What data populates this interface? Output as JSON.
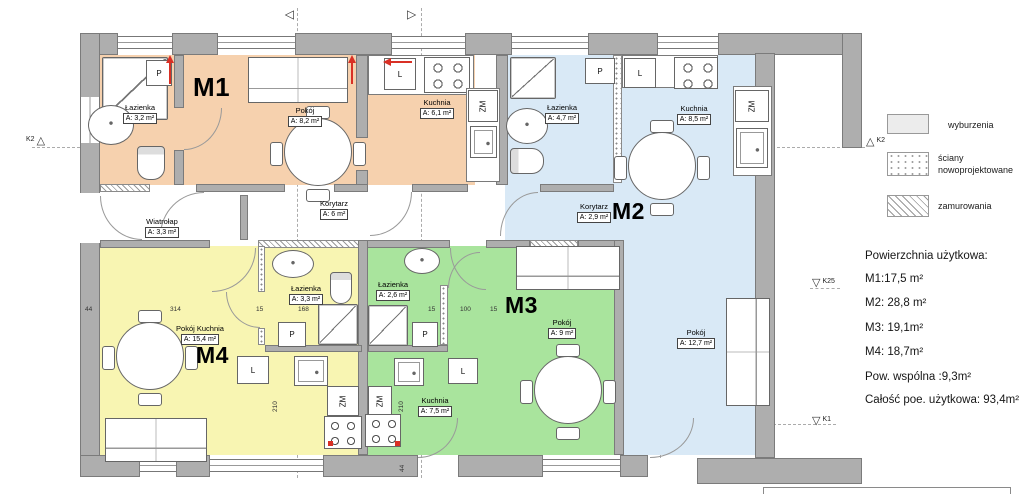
{
  "colors": {
    "m1": "#f6d1ae",
    "m2": "#d9e9f6",
    "m3": "#a9e49d",
    "m4": "#f8f5b2",
    "red": "#d93025"
  },
  "icons": {
    "triangle_up": "△",
    "triangle_down": "▽",
    "section_marker": "△"
  },
  "plan": {
    "apartments": {
      "m1": "M1",
      "m2": "M2",
      "m3": "M3",
      "m4": "M4"
    },
    "rooms": {
      "m1_bath": {
        "name": "Łazienka",
        "area": "A: 3,2 m²"
      },
      "m1_room": {
        "name": "Pokój",
        "area": "A: 8,2 m²"
      },
      "m1_kitchen": {
        "name": "Kuchnia",
        "area": "A: 6,1 m²"
      },
      "m2_bath": {
        "name": "Łazienka",
        "area": "A: 4,7 m²"
      },
      "m2_kitchen": {
        "name": "Kuchnia",
        "area": "A: 8,5 m²"
      },
      "m2_hall": {
        "name": "Korytarz",
        "area": "A: 2,9 m²"
      },
      "m2_room": {
        "name": "Pokój",
        "area": "A: 12,7 m²"
      },
      "m3_bath": {
        "name": "Łazienka",
        "area": "A: 2,6 m²"
      },
      "m3_kitchen": {
        "name": "Kuchnia",
        "area": "A: 7,5 m²"
      },
      "m3_room": {
        "name": "Pokój",
        "area": "A: 9 m²"
      },
      "m4_bath": {
        "name": "Łazienka",
        "area": "A: 3,3 m²"
      },
      "m4_main": {
        "name": "Pokój Kuchnia",
        "area": "A: 15,4 m²"
      },
      "hall": {
        "name": "Korytarz",
        "area": "A: 6 m²"
      },
      "vestibule": {
        "name": "Wiatrołap",
        "area": "A: 3,3 m²"
      }
    },
    "fixture_labels": {
      "p": "P",
      "l": "L",
      "zm": "ZM"
    },
    "dimensions": [
      "44",
      "314",
      "15",
      "168",
      "15",
      "100",
      "15",
      "210",
      "210",
      "44"
    ],
    "markers": {
      "k2_left": "K2",
      "k2_right": "K2",
      "k25": "K25",
      "k1": "K1"
    }
  },
  "legend": {
    "items": [
      {
        "label": "wyburzenia"
      },
      {
        "label": "ściany nowoprojektowane"
      },
      {
        "label": "zamurowania"
      }
    ]
  },
  "summary": {
    "title": "Powierzchnia użytkowa:",
    "lines": [
      "M1:17,5 m²",
      "M2: 28,8 m²",
      "M3: 19,1m²",
      "M4: 18,7m²",
      "Pow. wspólna :9,3m²",
      "Całość poe. użytkowa: 93,4m²"
    ]
  }
}
